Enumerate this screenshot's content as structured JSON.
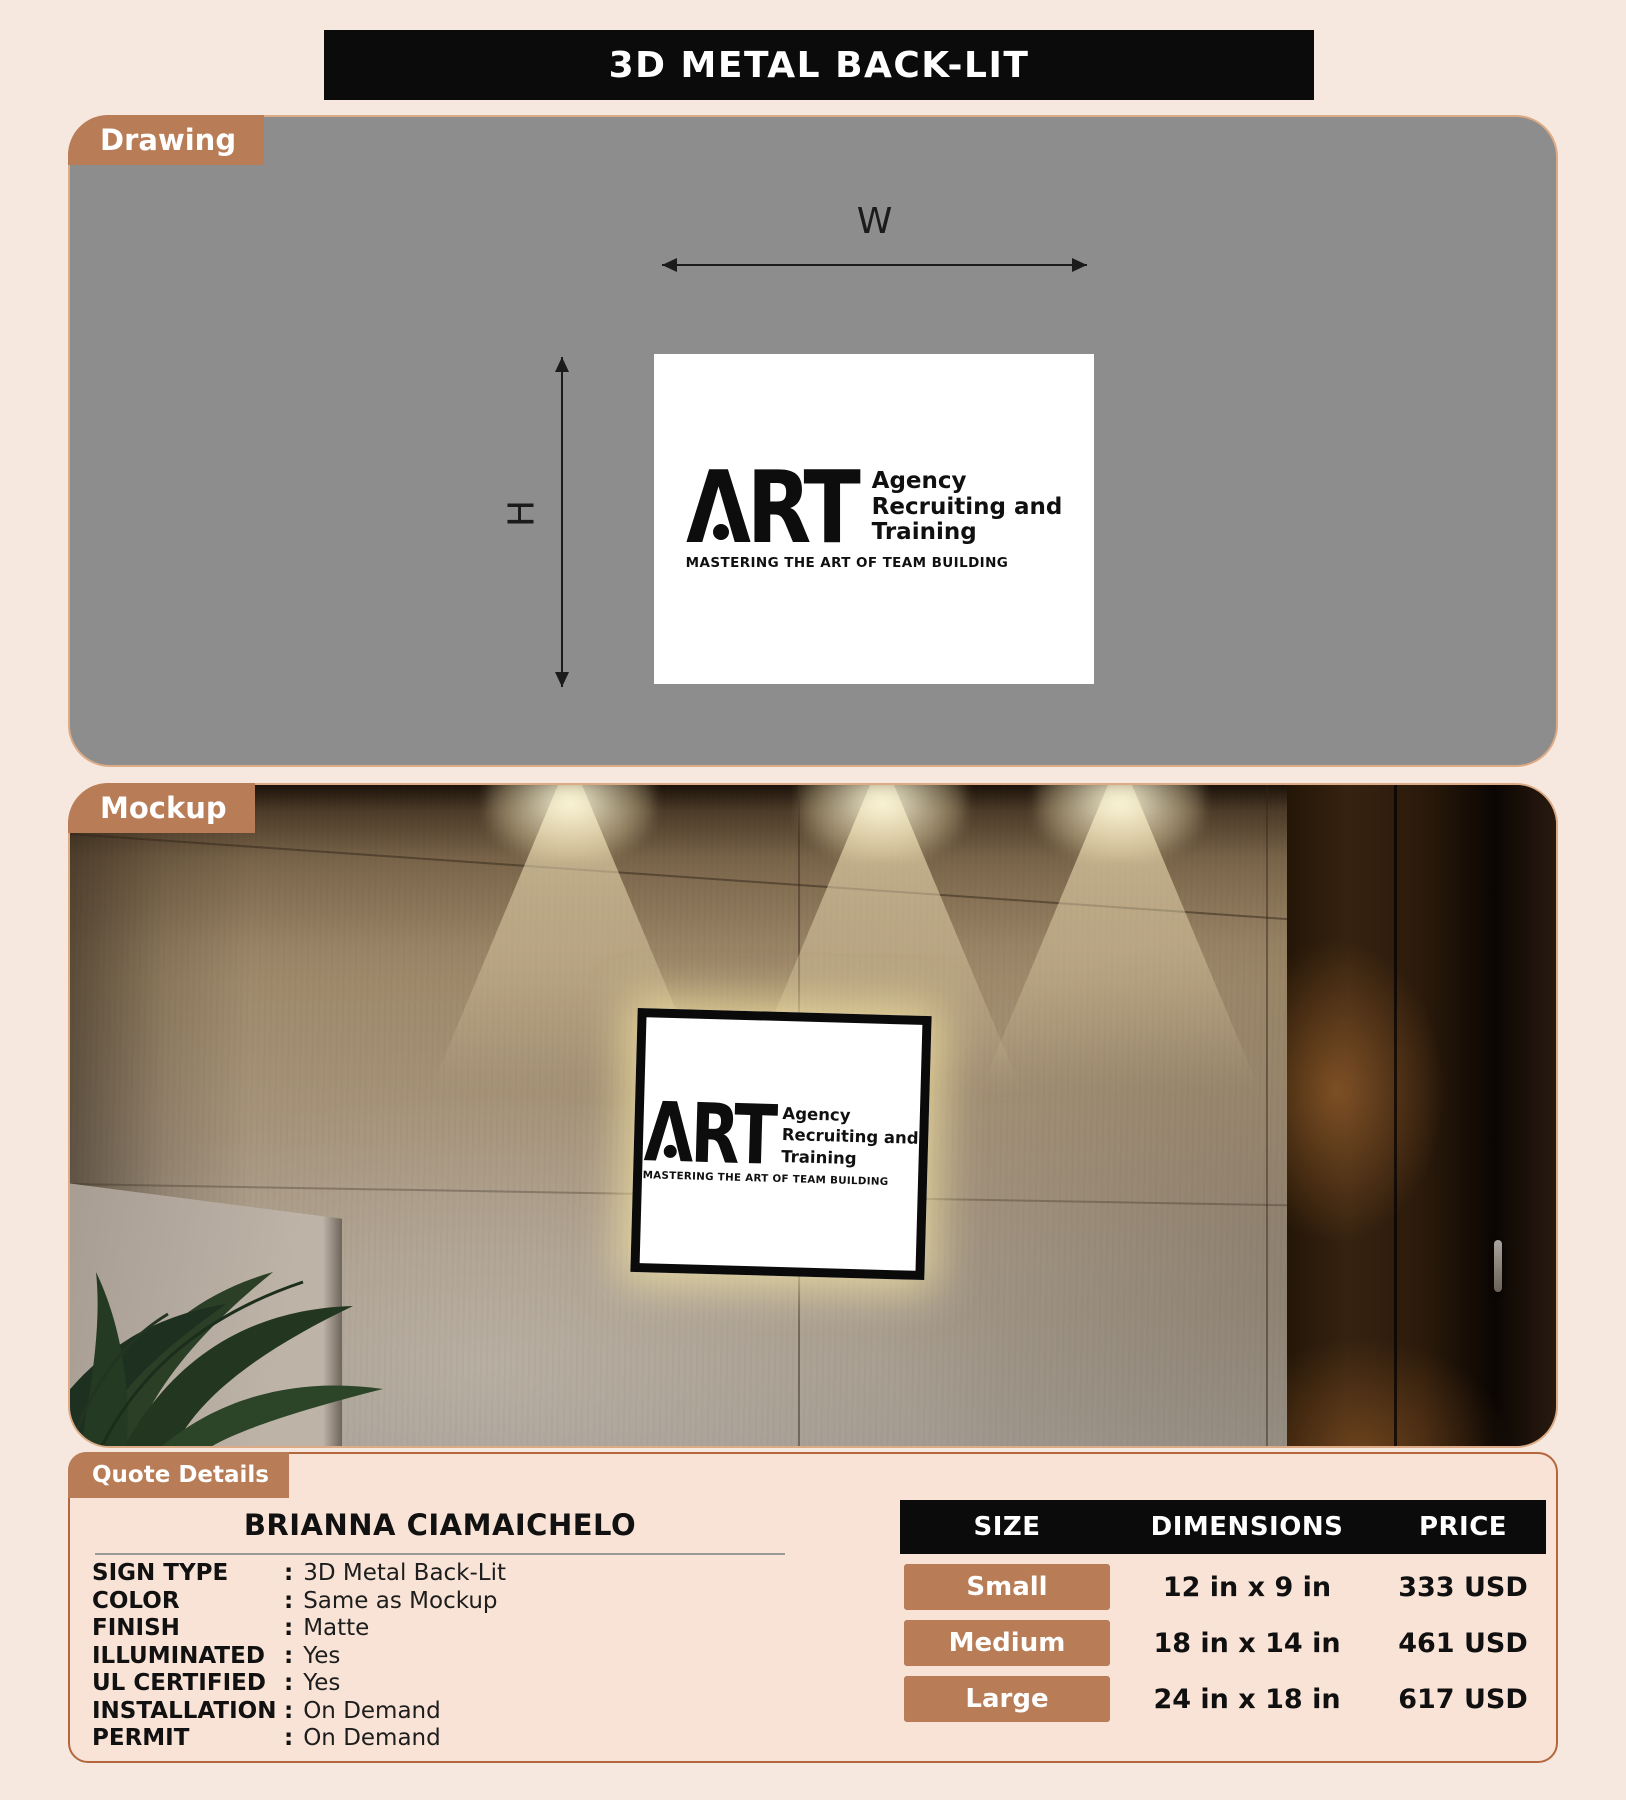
{
  "page": {
    "title": "3D METAL BACK-LIT"
  },
  "colors": {
    "page_bg": "#f6e8de",
    "accent_terracotta": "#b87c57",
    "quote_panel_border": "#b4673c",
    "drawing_panel_bg": "#8d8d8d",
    "table_header_bg": "#0b0b0b"
  },
  "drawing": {
    "tab_label": "Drawing",
    "width_label": "W",
    "height_label": "H"
  },
  "mockup": {
    "tab_label": "Mockup"
  },
  "logo": {
    "monogram": "ΛRT",
    "lines": [
      "Agency",
      "Recruiting and",
      "Training"
    ],
    "tagline": "MASTERING THE ART OF TEAM BUILDING"
  },
  "quote": {
    "tab_label": "Quote Details",
    "customer_name": "BRIANNA CIAMAICHELO",
    "colon": ":",
    "specs": [
      {
        "label": "SIGN TYPE",
        "value": "3D Metal Back-Lit"
      },
      {
        "label": "COLOR",
        "value": "Same as Mockup"
      },
      {
        "label": "FINISH",
        "value": "Matte"
      },
      {
        "label": "ILLUMINATED",
        "value": "Yes"
      },
      {
        "label": "UL CERTIFIED",
        "value": "Yes"
      },
      {
        "label": "INSTALLATION",
        "value": "On Demand"
      },
      {
        "label": "PERMIT",
        "value": "On Demand"
      }
    ],
    "table": {
      "headers": [
        "SIZE",
        "DIMENSIONS",
        "PRICE"
      ],
      "rows": [
        {
          "size": "Small",
          "dimensions": "12 in x 9 in",
          "price": "333 USD"
        },
        {
          "size": "Medium",
          "dimensions": "18 in x 14 in",
          "price": "461 USD"
        },
        {
          "size": "Large",
          "dimensions": "24 in x 18 in",
          "price": "617 USD"
        }
      ]
    }
  }
}
